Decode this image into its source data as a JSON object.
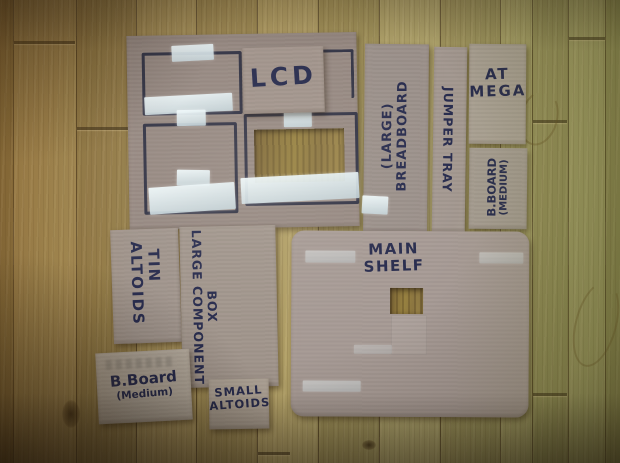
{
  "photo": {
    "pieces": {
      "lcd": {
        "label": "LCD"
      },
      "large_breadboard": {
        "lines": [
          "(LARGE)",
          "BREADBOARD"
        ]
      },
      "jumper_tray": {
        "label": "JUMPER TRAY"
      },
      "at_mega": {
        "lines": [
          "AT",
          "MEGA"
        ]
      },
      "b_board_medium_right": {
        "lines": [
          "B.BOARD",
          "(MEDIUM)"
        ]
      },
      "altoids_tin": {
        "lines": [
          "ALTOIDS",
          "TIN"
        ]
      },
      "large_component_box": {
        "lines": [
          "LARGE COMPONENT",
          "BOX"
        ]
      },
      "main_shelf": {
        "lines": [
          "MAIN",
          "SHELF"
        ]
      },
      "b_board_medium_bottom": {
        "lines": [
          "B.Board",
          "(Medium)"
        ]
      },
      "small_altoids": {
        "lines": [
          "SMALL",
          "ALTOIDS"
        ]
      }
    },
    "colors": {
      "ink": "#272b4d",
      "cardboard": "#9b8d86",
      "tape": "#dce8ec",
      "floor": "#a08a55"
    }
  }
}
